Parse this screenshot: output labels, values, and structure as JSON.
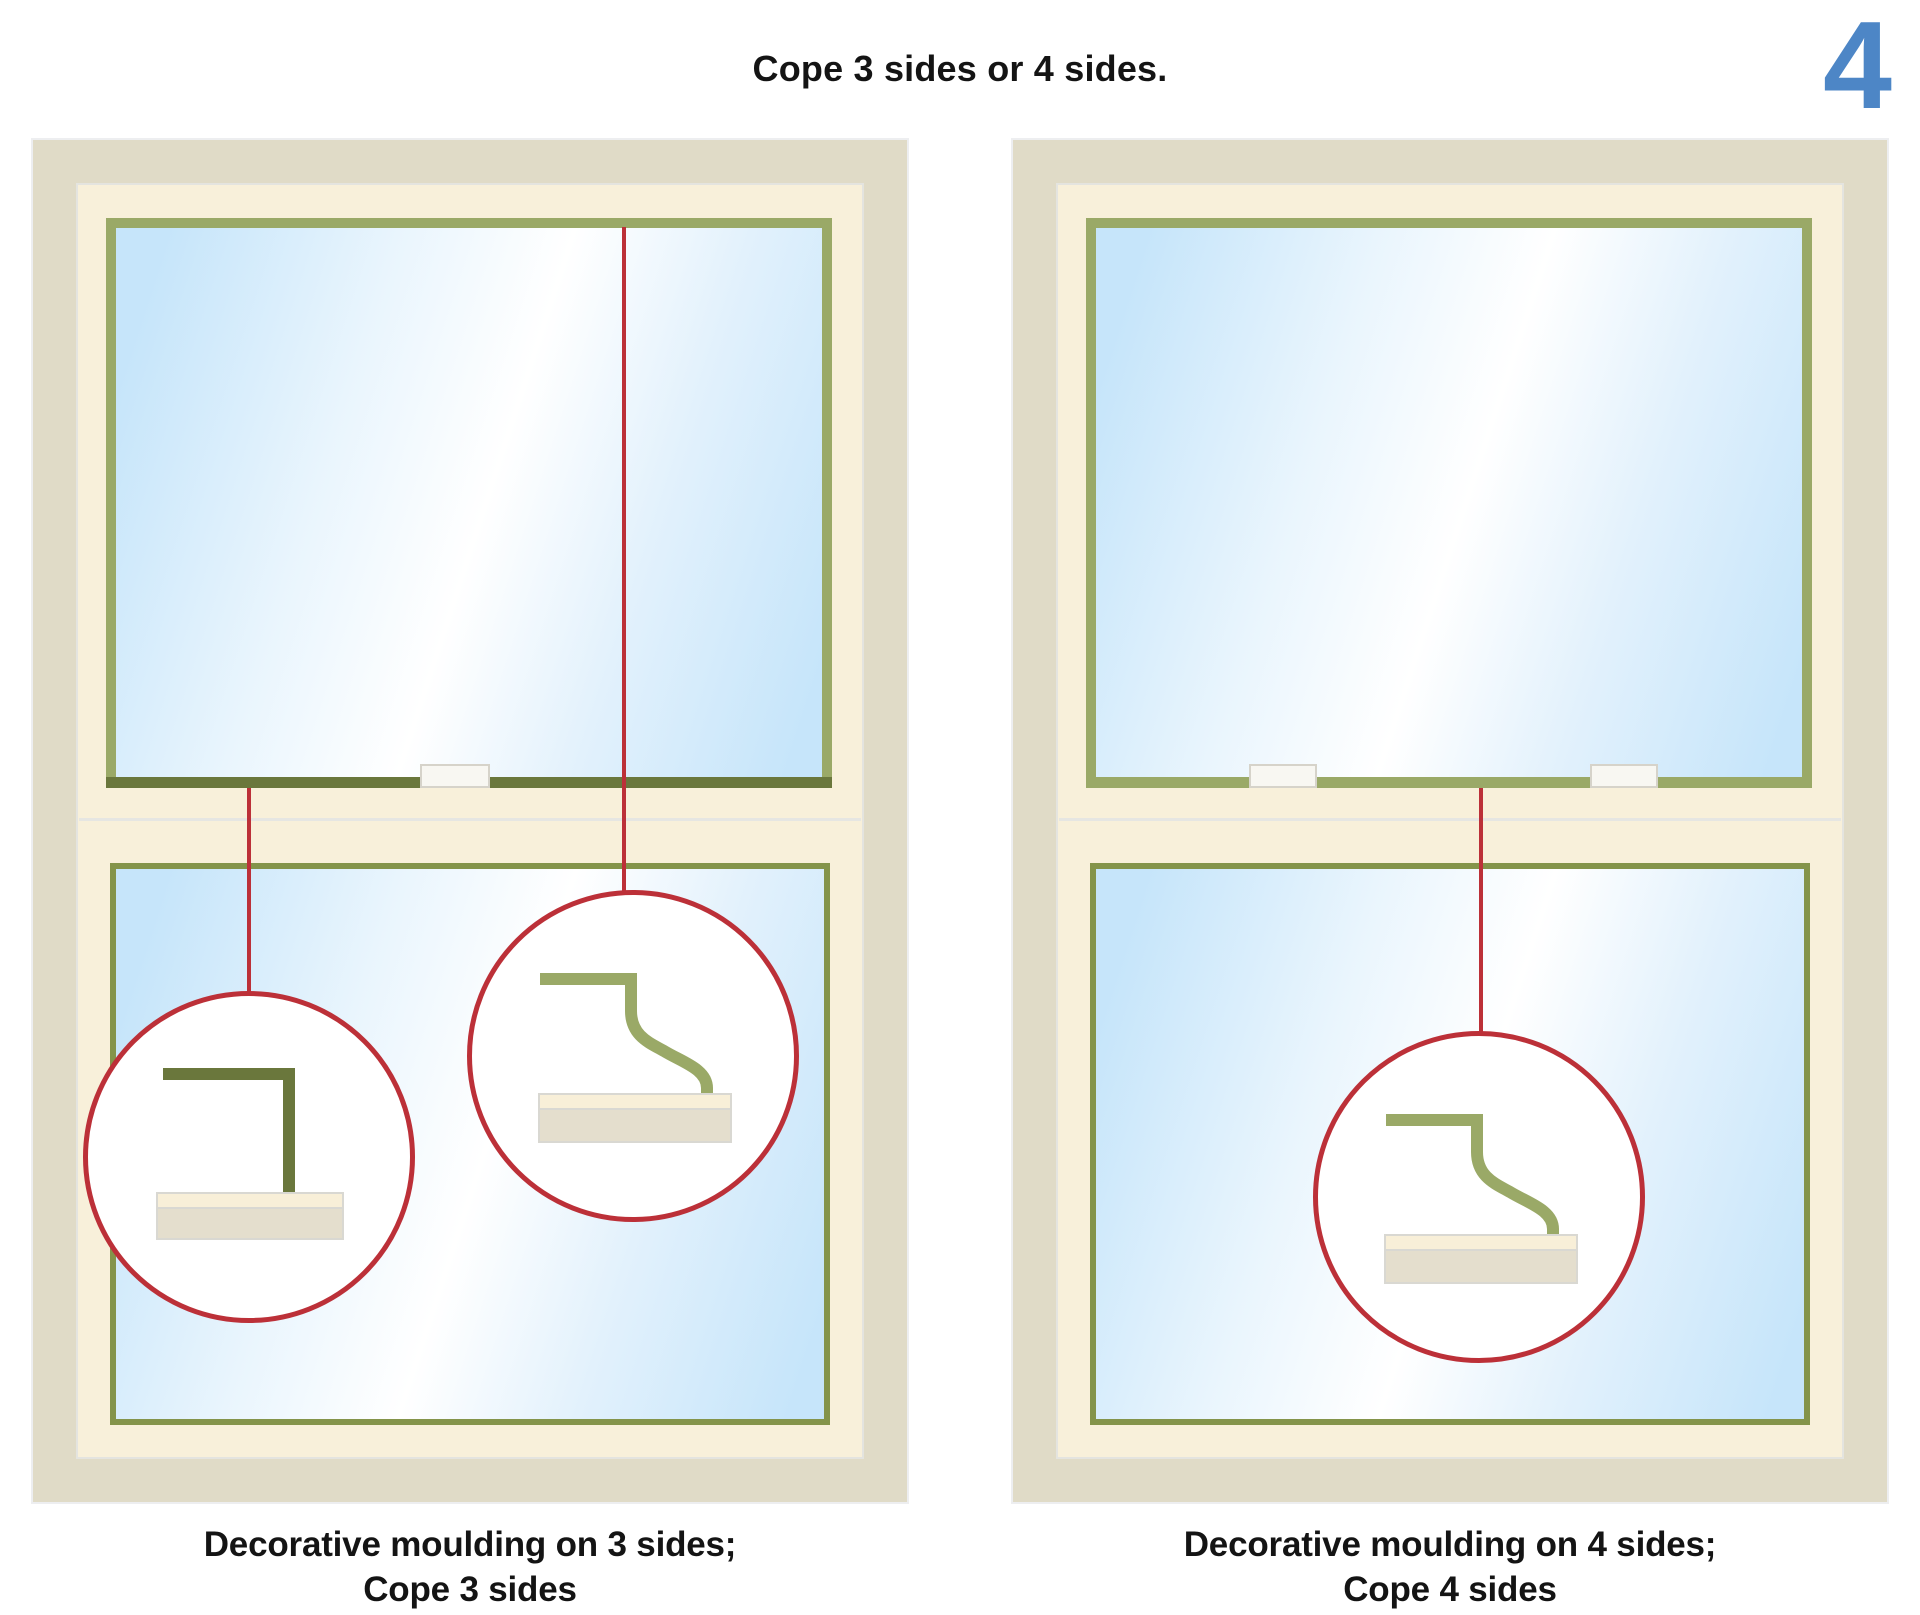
{
  "title": "Cope 3 sides or 4 sides.",
  "step_number": "4",
  "colors": {
    "accent_blue": "#4d86c6",
    "callout_red": "#bc3038",
    "moulding_green": "#9aa967",
    "rail_olive_dark": "#6a773c",
    "sash_green": "#84944a",
    "frame_tan": "#e0dbc7",
    "frame_cream": "#f8f0da",
    "sill_cream": "#f8efd8",
    "sill_tan": "#e4decd",
    "tab_white": "#f8f7f2",
    "text_black": "#141414"
  },
  "windows": [
    {
      "caption_line1": "Decorative moulding on 3 sides;",
      "caption_line2": "Cope 3 sides"
    },
    {
      "caption_line1": "Decorative moulding on 4 sides;",
      "caption_line2": "Cope 4 sides"
    }
  ]
}
